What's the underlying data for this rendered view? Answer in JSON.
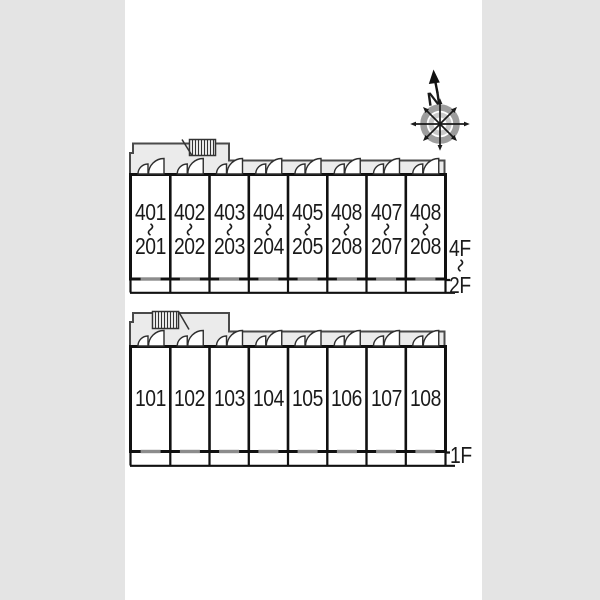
{
  "compass": {
    "north_label": "N"
  },
  "colors": {
    "background": "#e4e4e4",
    "paper": "#ffffff",
    "corridor_fill": "#ebebeb",
    "wall": "#111111",
    "corridor_stroke": "#4a4a4a",
    "window_gray": "#8c8c8c",
    "compass_ring_outer": "#9d9d9d",
    "compass_ring_inner": "#c9c9c9",
    "text": "#1a1a1a"
  },
  "plans": {
    "upper": {
      "floor_label_top": "4F",
      "floor_label_bottom": "2F",
      "units": [
        {
          "top": "401",
          "bottom": "201"
        },
        {
          "top": "402",
          "bottom": "202"
        },
        {
          "top": "403",
          "bottom": "203"
        },
        {
          "top": "404",
          "bottom": "204"
        },
        {
          "top": "405",
          "bottom": "205"
        },
        {
          "top": "408",
          "bottom": "208"
        },
        {
          "top": "407",
          "bottom": "207"
        },
        {
          "top": "408",
          "bottom": "208"
        }
      ]
    },
    "lower": {
      "floor_label": "1F",
      "units": [
        "101",
        "102",
        "103",
        "104",
        "105",
        "106",
        "107",
        "108"
      ]
    }
  }
}
